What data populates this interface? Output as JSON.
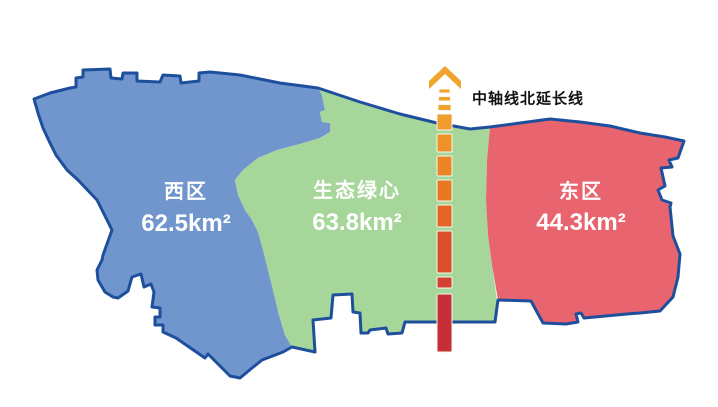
{
  "map": {
    "outline_color": "#1d4f9d",
    "background_color": "#ffffff"
  },
  "regions": [
    {
      "id": "west",
      "name": "西区",
      "area": "62.5km²",
      "color": "#7096cd",
      "text_color": "#ffffff"
    },
    {
      "id": "green-heart",
      "name": "生态绿心",
      "area": "63.8km²",
      "color": "#a7d69a",
      "text_color": "#ffffff"
    },
    {
      "id": "east",
      "name": "东区",
      "area": "44.3km²",
      "color": "#e8646f",
      "text_color": "#ffffff"
    }
  ],
  "axis": {
    "label": "中轴线北延长线",
    "label_color": "#111111",
    "arrow_icon": "up-chevron",
    "arrow_color": "#f0a42e",
    "dash_outline_color": "#f2f9ee",
    "segments": [
      {
        "y": 89,
        "h": 4,
        "w": 11,
        "color": "#f2a52f"
      },
      {
        "y": 96.5,
        "h": 4.5,
        "w": 12,
        "color": "#f1a22e"
      },
      {
        "y": 104.5,
        "h": 6,
        "w": 13,
        "color": "#f1a02e"
      },
      {
        "y": 114,
        "h": 16,
        "w": 15,
        "color": "#f09d2d"
      },
      {
        "y": 134,
        "h": 18,
        "w": 15,
        "color": "#ee9129"
      },
      {
        "y": 156,
        "h": 20,
        "w": 15,
        "color": "#ec8526"
      },
      {
        "y": 180,
        "h": 21,
        "w": 15,
        "color": "#e87722"
      },
      {
        "y": 205,
        "h": 22,
        "w": 15,
        "color": "#e26525"
      },
      {
        "y": 231,
        "h": 42,
        "w": 15,
        "color": "#d94f2b"
      },
      {
        "y": 277,
        "h": 11,
        "w": 15,
        "color": "#d2402f"
      },
      {
        "y": 294,
        "h": 58,
        "w": 15,
        "color": "#c62f38"
      }
    ],
    "center_x": 444.5
  }
}
